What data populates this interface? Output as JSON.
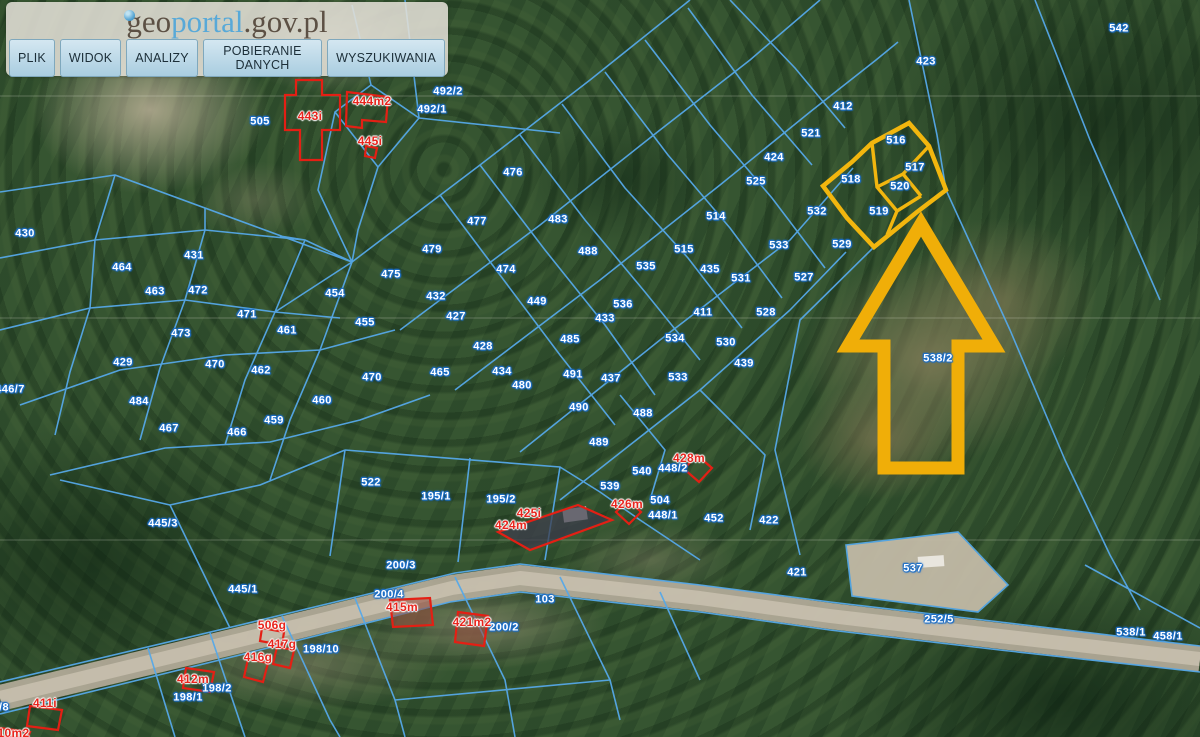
{
  "header": {
    "logo": {
      "geo": "geo",
      "portal": "portal",
      "suffix": ".gov.pl"
    },
    "menu": [
      "PLIK",
      "WIDOK",
      "ANALIZY",
      "POBIERANIE DANYCH",
      "WYSZUKIWANIA"
    ]
  },
  "colors": {
    "parcel_line_blue": "#55a8e8",
    "highlight_yellow": "#f2b60e",
    "building_red": "#e8251d",
    "label_halo_blue": "#1d6fc8"
  },
  "selection": {
    "highlighted_parcels": [
      "516",
      "517",
      "518",
      "519",
      "520"
    ],
    "arrow_target_parcel": "538/2"
  },
  "map": {
    "labels": [
      {
        "t": "542",
        "x": 1119,
        "y": 29,
        "kind": "parcel"
      },
      {
        "t": "423",
        "x": 926,
        "y": 62,
        "kind": "parcel"
      },
      {
        "t": "412",
        "x": 843,
        "y": 107,
        "kind": "parcel"
      },
      {
        "t": "521",
        "x": 811,
        "y": 134,
        "kind": "parcel"
      },
      {
        "t": "424",
        "x": 774,
        "y": 158,
        "kind": "parcel"
      },
      {
        "t": "525",
        "x": 756,
        "y": 182,
        "kind": "parcel"
      },
      {
        "t": "514",
        "x": 716,
        "y": 217,
        "kind": "parcel"
      },
      {
        "t": "532",
        "x": 817,
        "y": 212,
        "kind": "parcel"
      },
      {
        "t": "533",
        "x": 779,
        "y": 246,
        "kind": "parcel"
      },
      {
        "t": "529",
        "x": 842,
        "y": 245,
        "kind": "parcel"
      },
      {
        "t": "515",
        "x": 684,
        "y": 250,
        "kind": "parcel"
      },
      {
        "t": "535",
        "x": 646,
        "y": 267,
        "kind": "parcel"
      },
      {
        "t": "435",
        "x": 710,
        "y": 270,
        "kind": "parcel"
      },
      {
        "t": "531",
        "x": 741,
        "y": 279,
        "kind": "parcel"
      },
      {
        "t": "527",
        "x": 804,
        "y": 278,
        "kind": "parcel"
      },
      {
        "t": "488",
        "x": 588,
        "y": 252,
        "kind": "parcel"
      },
      {
        "t": "536",
        "x": 623,
        "y": 305,
        "kind": "parcel"
      },
      {
        "t": "433",
        "x": 605,
        "y": 319,
        "kind": "parcel"
      },
      {
        "t": "411",
        "x": 703,
        "y": 313,
        "kind": "parcel"
      },
      {
        "t": "528",
        "x": 766,
        "y": 313,
        "kind": "parcel"
      },
      {
        "t": "534",
        "x": 675,
        "y": 339,
        "kind": "parcel"
      },
      {
        "t": "530",
        "x": 726,
        "y": 343,
        "kind": "parcel"
      },
      {
        "t": "491",
        "x": 573,
        "y": 375,
        "kind": "parcel"
      },
      {
        "t": "437",
        "x": 611,
        "y": 379,
        "kind": "parcel"
      },
      {
        "t": "533",
        "x": 678,
        "y": 378,
        "kind": "parcel"
      },
      {
        "t": "439",
        "x": 744,
        "y": 364,
        "kind": "parcel"
      },
      {
        "t": "490",
        "x": 579,
        "y": 408,
        "kind": "parcel"
      },
      {
        "t": "488",
        "x": 643,
        "y": 414,
        "kind": "parcel"
      },
      {
        "t": "489",
        "x": 599,
        "y": 443,
        "kind": "parcel"
      },
      {
        "t": "540",
        "x": 642,
        "y": 472,
        "kind": "parcel"
      },
      {
        "t": "539",
        "x": 610,
        "y": 487,
        "kind": "parcel"
      },
      {
        "t": "448/2",
        "x": 673,
        "y": 469,
        "kind": "parcel"
      },
      {
        "t": "504",
        "x": 660,
        "y": 501,
        "kind": "parcel"
      },
      {
        "t": "448/1",
        "x": 663,
        "y": 516,
        "kind": "parcel"
      },
      {
        "t": "452",
        "x": 714,
        "y": 519,
        "kind": "parcel"
      },
      {
        "t": "422",
        "x": 769,
        "y": 521,
        "kind": "parcel"
      },
      {
        "t": "421",
        "x": 797,
        "y": 573,
        "kind": "parcel"
      },
      {
        "t": "537",
        "x": 913,
        "y": 569,
        "kind": "parcel"
      },
      {
        "t": "252/5",
        "x": 939,
        "y": 620,
        "kind": "parcel"
      },
      {
        "t": "538/1",
        "x": 1131,
        "y": 633,
        "kind": "parcel"
      },
      {
        "t": "458/1",
        "x": 1168,
        "y": 637,
        "kind": "parcel"
      },
      {
        "t": "538/2",
        "x": 938,
        "y": 359,
        "kind": "parcel"
      },
      {
        "t": "505",
        "x": 260,
        "y": 122,
        "kind": "parcel"
      },
      {
        "t": "492/1",
        "x": 432,
        "y": 110,
        "kind": "parcel"
      },
      {
        "t": "492/2",
        "x": 448,
        "y": 92,
        "kind": "parcel"
      },
      {
        "t": "430",
        "x": 25,
        "y": 234,
        "kind": "parcel"
      },
      {
        "t": "431",
        "x": 194,
        "y": 256,
        "kind": "parcel"
      },
      {
        "t": "464",
        "x": 122,
        "y": 268,
        "kind": "parcel"
      },
      {
        "t": "463",
        "x": 155,
        "y": 292,
        "kind": "parcel"
      },
      {
        "t": "472",
        "x": 198,
        "y": 291,
        "kind": "parcel"
      },
      {
        "t": "471",
        "x": 247,
        "y": 315,
        "kind": "parcel"
      },
      {
        "t": "461",
        "x": 287,
        "y": 331,
        "kind": "parcel"
      },
      {
        "t": "454",
        "x": 335,
        "y": 294,
        "kind": "parcel"
      },
      {
        "t": "473",
        "x": 181,
        "y": 334,
        "kind": "parcel"
      },
      {
        "t": "429",
        "x": 123,
        "y": 363,
        "kind": "parcel"
      },
      {
        "t": "470",
        "x": 215,
        "y": 365,
        "kind": "parcel"
      },
      {
        "t": "462",
        "x": 261,
        "y": 371,
        "kind": "parcel"
      },
      {
        "t": "484",
        "x": 139,
        "y": 402,
        "kind": "parcel"
      },
      {
        "t": "467",
        "x": 169,
        "y": 429,
        "kind": "parcel"
      },
      {
        "t": "466",
        "x": 237,
        "y": 433,
        "kind": "parcel"
      },
      {
        "t": "460",
        "x": 322,
        "y": 401,
        "kind": "parcel"
      },
      {
        "t": "459",
        "x": 274,
        "y": 421,
        "kind": "parcel"
      },
      {
        "t": "476",
        "x": 513,
        "y": 173,
        "kind": "parcel"
      },
      {
        "t": "477",
        "x": 477,
        "y": 222,
        "kind": "parcel"
      },
      {
        "t": "483",
        "x": 558,
        "y": 220,
        "kind": "parcel"
      },
      {
        "t": "479",
        "x": 432,
        "y": 250,
        "kind": "parcel"
      },
      {
        "t": "475",
        "x": 391,
        "y": 275,
        "kind": "parcel"
      },
      {
        "t": "474",
        "x": 506,
        "y": 270,
        "kind": "parcel"
      },
      {
        "t": "455",
        "x": 365,
        "y": 323,
        "kind": "parcel"
      },
      {
        "t": "432",
        "x": 436,
        "y": 297,
        "kind": "parcel"
      },
      {
        "t": "427",
        "x": 456,
        "y": 317,
        "kind": "parcel"
      },
      {
        "t": "428",
        "x": 483,
        "y": 347,
        "kind": "parcel"
      },
      {
        "t": "449",
        "x": 537,
        "y": 302,
        "kind": "parcel"
      },
      {
        "t": "485",
        "x": 570,
        "y": 340,
        "kind": "parcel"
      },
      {
        "t": "434",
        "x": 502,
        "y": 372,
        "kind": "parcel"
      },
      {
        "t": "480",
        "x": 522,
        "y": 386,
        "kind": "parcel"
      },
      {
        "t": "470",
        "x": 372,
        "y": 378,
        "kind": "parcel"
      },
      {
        "t": "465",
        "x": 440,
        "y": 373,
        "kind": "parcel"
      },
      {
        "t": "446/7",
        "x": 10,
        "y": 390,
        "kind": "parcel"
      },
      {
        "t": "445/3",
        "x": 163,
        "y": 524,
        "kind": "parcel"
      },
      {
        "t": "522",
        "x": 371,
        "y": 483,
        "kind": "parcel"
      },
      {
        "t": "195/1",
        "x": 436,
        "y": 497,
        "kind": "parcel"
      },
      {
        "t": "195/2",
        "x": 501,
        "y": 500,
        "kind": "parcel"
      },
      {
        "t": "200/3",
        "x": 401,
        "y": 566,
        "kind": "parcel"
      },
      {
        "t": "445/1",
        "x": 243,
        "y": 590,
        "kind": "parcel"
      },
      {
        "t": "200/4",
        "x": 389,
        "y": 595,
        "kind": "parcel"
      },
      {
        "t": "200/2",
        "x": 504,
        "y": 628,
        "kind": "parcel"
      },
      {
        "t": "103",
        "x": 545,
        "y": 600,
        "kind": "parcel"
      },
      {
        "t": "198/10",
        "x": 321,
        "y": 650,
        "kind": "parcel"
      },
      {
        "t": "198/2",
        "x": 217,
        "y": 689,
        "kind": "parcel"
      },
      {
        "t": "198/1",
        "x": 188,
        "y": 698,
        "kind": "parcel"
      },
      {
        "t": "/8",
        "x": 4,
        "y": 708,
        "kind": "parcel"
      },
      {
        "t": "516",
        "x": 896,
        "y": 141,
        "kind": "selected"
      },
      {
        "t": "517",
        "x": 915,
        "y": 168,
        "kind": "selected"
      },
      {
        "t": "518",
        "x": 851,
        "y": 180,
        "kind": "selected"
      },
      {
        "t": "520",
        "x": 900,
        "y": 187,
        "kind": "selected"
      },
      {
        "t": "519",
        "x": 879,
        "y": 212,
        "kind": "selected"
      },
      {
        "t": "443i",
        "x": 310,
        "y": 116,
        "kind": "building"
      },
      {
        "t": "444m2",
        "x": 372,
        "y": 101,
        "kind": "building"
      },
      {
        "t": "445i",
        "x": 370,
        "y": 141,
        "kind": "building"
      },
      {
        "t": "428m",
        "x": 689,
        "y": 458,
        "kind": "building"
      },
      {
        "t": "426m",
        "x": 627,
        "y": 504,
        "kind": "building"
      },
      {
        "t": "425i",
        "x": 529,
        "y": 513,
        "kind": "building"
      },
      {
        "t": "424m",
        "x": 511,
        "y": 525,
        "kind": "building"
      },
      {
        "t": "415m",
        "x": 402,
        "y": 607,
        "kind": "building"
      },
      {
        "t": "506g",
        "x": 272,
        "y": 625,
        "kind": "building"
      },
      {
        "t": "421m2",
        "x": 472,
        "y": 622,
        "kind": "building"
      },
      {
        "t": "417g",
        "x": 282,
        "y": 644,
        "kind": "building"
      },
      {
        "t": "416g",
        "x": 258,
        "y": 657,
        "kind": "building"
      },
      {
        "t": "412m",
        "x": 193,
        "y": 679,
        "kind": "building"
      },
      {
        "t": "411i",
        "x": 45,
        "y": 703,
        "kind": "building"
      },
      {
        "t": "410m2",
        "x": 10,
        "y": 733,
        "kind": "building"
      }
    ]
  }
}
